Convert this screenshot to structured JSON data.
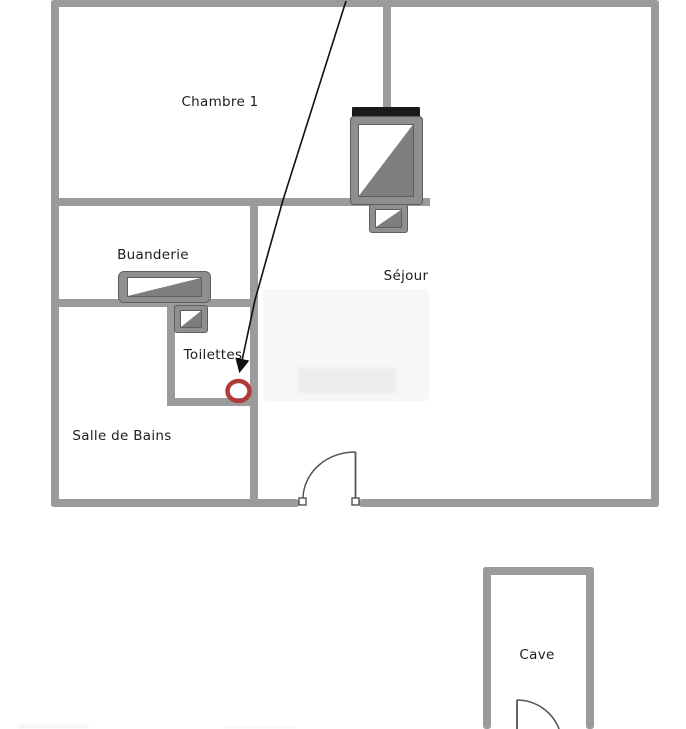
{
  "diagram_type": "floor-plan",
  "rooms": {
    "chambre1": "Chambre 1",
    "buanderie": "Buanderie",
    "sejour": "Séjour",
    "toilettes": "Toilettes",
    "salle_de_bains": "Salle de Bains",
    "cave": "Cave"
  },
  "annotation": {
    "marker_shape": "circle",
    "marker_color": "#b03a3a",
    "arrow_color": "#111111",
    "arrow_points_to": "Toilettes"
  },
  "colors": {
    "wall": "#9b9b9b",
    "appliance_frame": "#8f8f8f",
    "appliance_dark_fill": "#7e7e7e",
    "appliance_top_bar": "#1a1a1a",
    "door_line": "#555555",
    "text": "#1c1c1c",
    "background": "#ffffff"
  }
}
